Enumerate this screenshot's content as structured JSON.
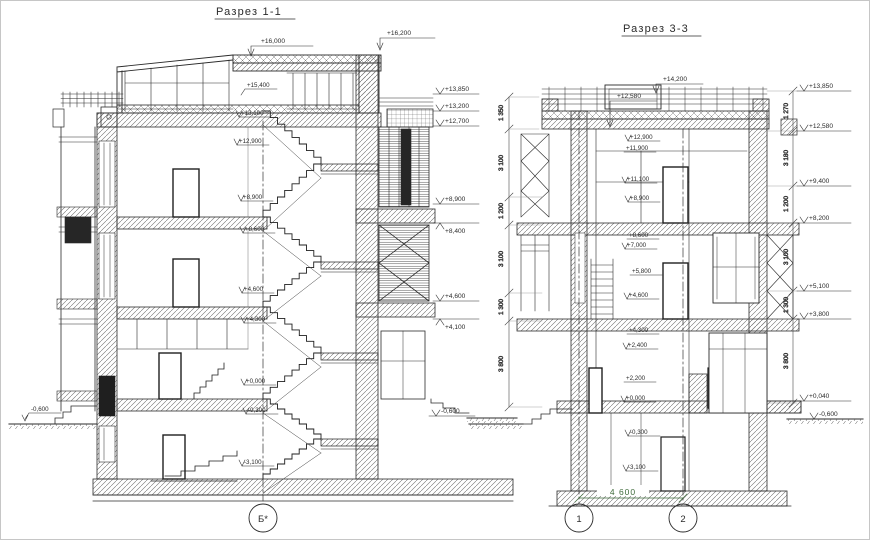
{
  "palette": {
    "ink": "#2b2b2b",
    "hatch": "#666666",
    "dim_green": "#3f6b3b"
  },
  "sections": {
    "s11": {
      "title": "Разрез 1-1",
      "axis": "Б*",
      "left_mark": "-0,600",
      "top_marks": [
        "+16,000",
        "+16,200"
      ],
      "right_marks": [
        "+13,850",
        "+13,200",
        "+12,700",
        "+8,900",
        "+8,400",
        "+4,600",
        "+4,100",
        "-0,600"
      ],
      "inner_marks": [
        "+15,400",
        "+13,100",
        "+12,900",
        "+8,900",
        "+8,600",
        "+4,600",
        "+4,300",
        "+0,000",
        "-0,300",
        "-3,100"
      ]
    },
    "s33": {
      "title": "Разрез 3-3",
      "axes": [
        "1",
        "2"
      ],
      "bottom_dim": "4 600",
      "top_marks": [
        "+14,200",
        "+12,580"
      ],
      "right_marks": [
        "+13,850",
        "+12,580",
        "+9,400",
        "+8,200",
        "+5,100",
        "+3,800",
        "+0,040",
        "-0,600"
      ],
      "inner_marks": [
        "+12,900",
        "+11,900",
        "+11,100",
        "+8,900",
        "+8,600",
        "+7,000",
        "+5,800",
        "+4,600",
        "+4,300",
        "+2,400",
        "+2,200",
        "+0,000",
        "-0,300",
        "-3,100"
      ],
      "left_dims": [
        "1 350",
        "3 100",
        "1 200",
        "3 100",
        "1 300",
        "3 800"
      ],
      "right_dims": [
        "1 270",
        "3 180",
        "1 200",
        "3 100",
        "1 300",
        "3 800"
      ]
    }
  }
}
